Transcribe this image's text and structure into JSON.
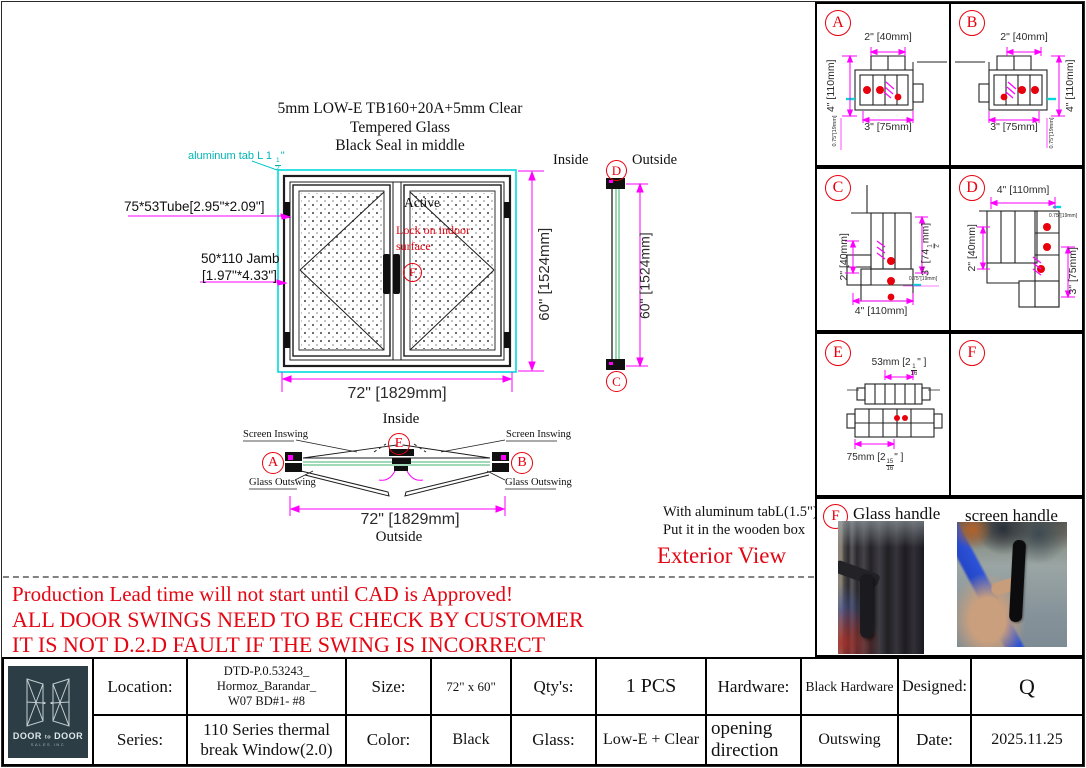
{
  "colors": {
    "dimension_line": "#ff00ff",
    "frame_highlight": "#00dcdc",
    "marker_red": "#e8000d",
    "glass_line": "#009a44",
    "logo_bg": "#2c3d45",
    "warning_red": "#e30613"
  },
  "glass_spec": {
    "line1": "5mm LOW-E TB160+20A+5mm Clear",
    "line2": "Tempered  Glass",
    "line3": "Black Seal in middle"
  },
  "elevation": {
    "tab_note": {
      "pre": "aluminum tab L 1",
      "num": "1",
      "den": "2",
      "post": "\""
    },
    "tube_label": "75*53Tube[2.95\"*2.09\"]",
    "jamb_line1": "50*110 Jamb",
    "jamb_line2": "[1.97\"*4.33\"]",
    "active": "Active",
    "lock_line1": "Lock on indoor",
    "lock_line2": "surface",
    "marker": "F",
    "width_dim": "72\" [1829mm]",
    "height_dim": "60\" [1524mm]"
  },
  "side_view": {
    "inside": "Inside",
    "outside": "Outside",
    "top_marker": "D",
    "bottom_marker": "C",
    "height_dim": "60\" [1524mm]"
  },
  "plan_view": {
    "inside": "Inside",
    "outside": "Outside",
    "left_marker": "A",
    "right_marker": "B",
    "center_marker": "E",
    "screen_inswing_left": "Screen Inswing",
    "screen_inswing_right": "Screen Inswing",
    "glass_outswing_left": "Glass Outswing",
    "glass_outswing_right": "Glass Outswing",
    "width_dim": "72\" [1829mm]"
  },
  "notes": {
    "line1": "With aluminum tabL(1.5\").",
    "line2": "Put it in the wooden box",
    "exterior_view": "Exterior View"
  },
  "warning": {
    "line1": "Production Lead time will not start until CAD is Approved!",
    "line2": "ALL DOOR SWINGS NEED TO BE CHECK BY CUSTOMER",
    "line3": "IT IS NOT D.2.D FAULT IF THE SWING IS  INCORRECT"
  },
  "details": {
    "a": {
      "letter": "A",
      "dim_top": "2\" [40mm]",
      "dim_left": "4\" [110mm]",
      "dim_bottom": "3\" [75mm]",
      "dim_small": "0.75\"[19mm]"
    },
    "b": {
      "letter": "B",
      "dim_top": "2\" [40mm]",
      "dim_right": "4\" [110mm]",
      "dim_bottom": "3\" [75mm]",
      "dim_small": "0.75\"[19mm]"
    },
    "c": {
      "letter": "C",
      "dim_left": "2\" [40mm]",
      "dim_right": {
        "pre": "3\" [74",
        "num": "1",
        "den": "2",
        "post": "mm]"
      },
      "dim_bottom": "4\" [110mm]",
      "dim_small": "0.75\"[19mm]"
    },
    "d": {
      "letter": "D",
      "dim_top": "4\" [110mm]",
      "dim_left": "2\" [40mm]",
      "dim_right": "3\" [75mm]",
      "dim_small": "0.75\"[19mm]"
    },
    "e": {
      "letter": "E",
      "dim_top": {
        "pre": "53mm [2",
        "num": "1",
        "den": "16",
        "post": "\" ]"
      },
      "dim_bottom": {
        "pre": "75mm [2",
        "num": "15",
        "den": "16",
        "post": "\" ]"
      }
    },
    "f": {
      "letter": "F"
    }
  },
  "photos": {
    "marker": "F",
    "glass_handle": "Glass handle",
    "screen_handle": "screen handle"
  },
  "title_block": {
    "logo": {
      "brand_left": "DOOR",
      "brand_mid": "to",
      "brand_right": "DOOR",
      "subtitle": "SALES INC"
    },
    "location": {
      "label": "Location:",
      "line1": "DTD-P.0.53243_",
      "line2": "Hormoz_Barandar_",
      "line3": "W07 BD#1- #8"
    },
    "size": {
      "label": "Size:",
      "value": "72\" x 60\""
    },
    "qty": {
      "label": "Qty's:",
      "value": "1 PCS"
    },
    "hardware": {
      "label": "Hardware:",
      "value": "Black Hardware"
    },
    "designed": {
      "label": "Designed:",
      "value": "Q"
    },
    "series": {
      "label": "Series:",
      "line1": "110 Series thermal",
      "line2": "break Window(2.0)"
    },
    "color": {
      "label": "Color:",
      "value": "Black"
    },
    "glass": {
      "label": "Glass:",
      "value": "Low-E  + Clear"
    },
    "opening": {
      "label_line1": "opening",
      "label_line2": "direction",
      "value": "Outswing"
    },
    "date": {
      "label": "Date:",
      "value": "2025.11.25"
    }
  }
}
